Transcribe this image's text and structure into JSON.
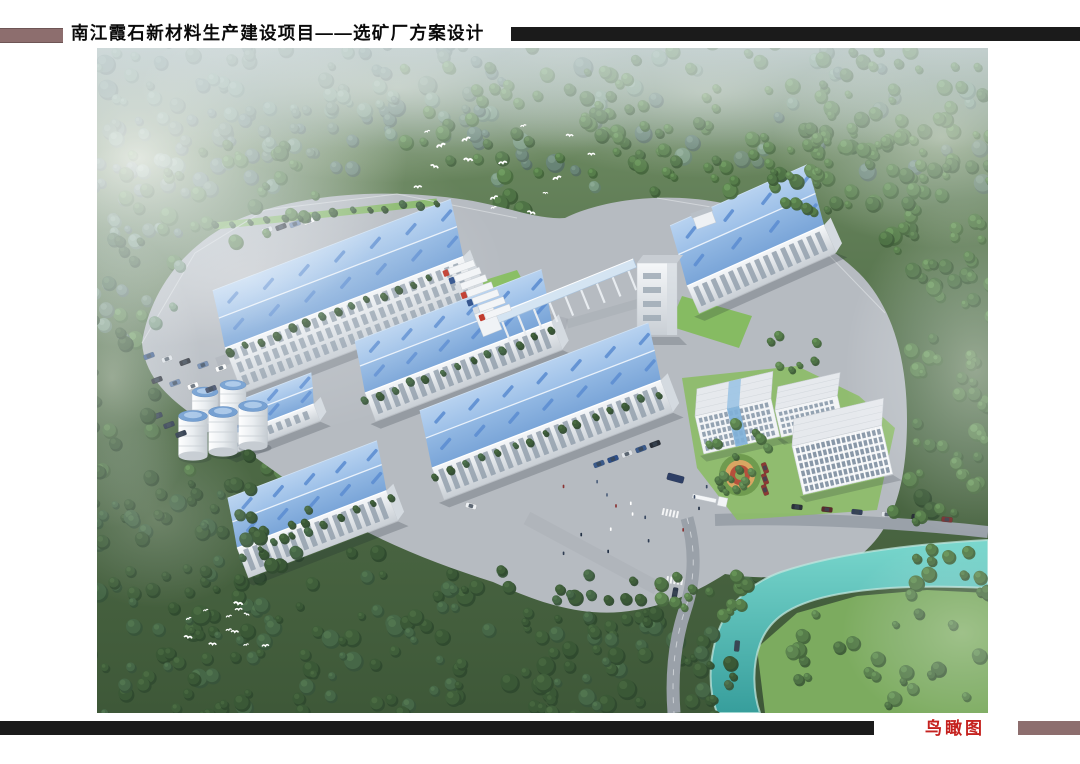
{
  "header": {
    "title": "南江霞石新材料生产建设项目——选矿厂方案设计"
  },
  "footer": {
    "caption": "鸟瞰图"
  },
  "palette": {
    "accent_maroon": "#8d6e6e",
    "bar_black": "#1b1b1b",
    "caption_red": "#c5221f",
    "roof_blue": "#84aede",
    "roof_skylight_blue": "#5d8ed2",
    "wall_white": "#f2f4f6",
    "forest_green": "#4e6f41",
    "lawn_green": "#8abf65",
    "water_teal": "#49b8b2",
    "pavement_gray": "#b6bbc1",
    "mist_white": "#ffffff"
  },
  "scene": {
    "type": "architectural-aerial-rendering",
    "subject": "bird's-eye view of a beneficiation plant campus set in forested hills",
    "elements": [
      "blue-roof workshop buildings",
      "elevated conveyor gallery",
      "transfer tower",
      "white silos",
      "office buildings",
      "landscaped garden",
      "entrance plaza",
      "winding turquoise river",
      "dense forest",
      "mist",
      "flocks of white birds"
    ]
  }
}
